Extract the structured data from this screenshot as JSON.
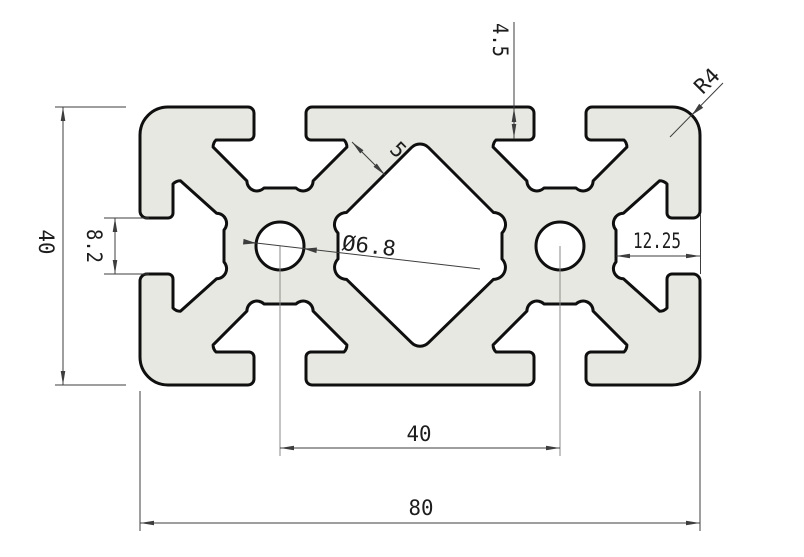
{
  "drawing": {
    "type": "technical-cad-drawing",
    "subject": "aluminum-extrusion-profile-cross-section",
    "colors": {
      "background": "#ffffff",
      "material_fill": "#e8e8e2",
      "outline": "#0f0f0f",
      "dimension": "#3d3d3d",
      "centerline": "#8a8a8a"
    }
  },
  "dimensions": {
    "profile_width": "80",
    "profile_height": "40",
    "hole_spacing": "40",
    "hole_diameter": "Ø6.8",
    "end_slot_opening": "8.2",
    "end_slot_depth": "12.25",
    "slot_lip_depth": "4.5",
    "web_thickness": "5",
    "corner_radius": "R4"
  }
}
